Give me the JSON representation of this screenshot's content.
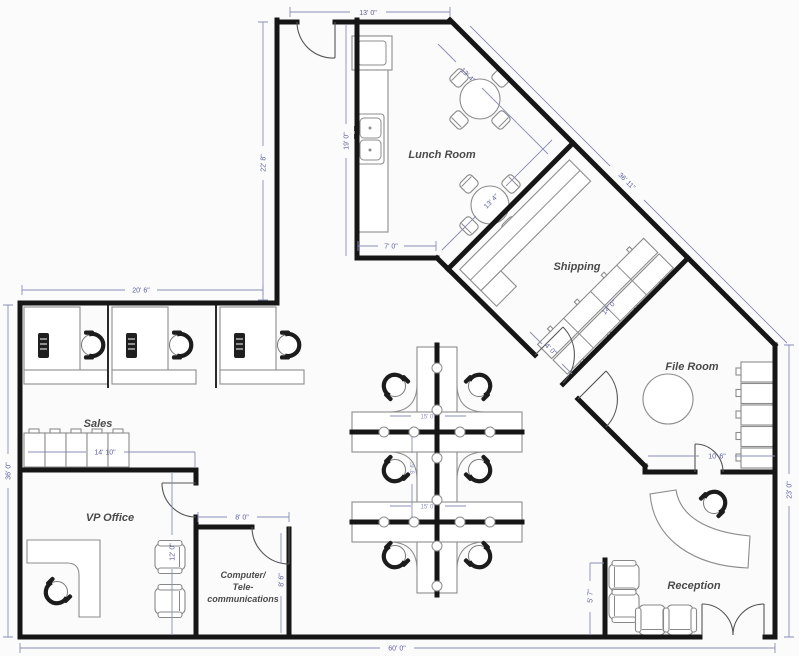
{
  "rooms": {
    "lunch": {
      "label": "Lunch Room"
    },
    "shipping": {
      "label": "Shipping"
    },
    "file": {
      "label": "File Room"
    },
    "sales": {
      "label": "Sales"
    },
    "vp": {
      "label": "VP Office"
    },
    "computer": {
      "line1": "Computer/",
      "line2": "Tele-",
      "line3": "communications"
    },
    "reception": {
      "label": "Reception"
    }
  },
  "dims": {
    "top_width": "13' 0\"",
    "upper_left_height": "22' 8\"",
    "upper_left_width": "20' 6\"",
    "left_height": "36' 0\"",
    "bottom_width": "60' 0\"",
    "right_height": "23' 0\"",
    "diagonal_wall": "36' 11\"",
    "kitchen_wall": "19' 0\"",
    "lunch_bottom": "7' 0\"",
    "lunch_diag_a": "13' 4\"",
    "lunch_diag_b": "13' 4\"",
    "sales_cabinets": "14' 10\"",
    "vp_height": "12' 0\"",
    "computer_width": "8' 0\"",
    "computer_height": "8' 6\"",
    "reception_wall": "5' 7\"",
    "file_bottom": "10' 6\"",
    "shipping_door": "4' 0\"",
    "shipping_shelf": "14' 0\"",
    "cubicle_width_a": "15' 0\"",
    "cubicle_height": "9' 6\"",
    "cubicle_width_b": "15' 0\""
  },
  "colors": {
    "wall": "#161616",
    "furniture": "#8c8c8c",
    "dimension": "#7c7fae",
    "label": "#4a4a4a",
    "background": "#fbfbfb"
  }
}
